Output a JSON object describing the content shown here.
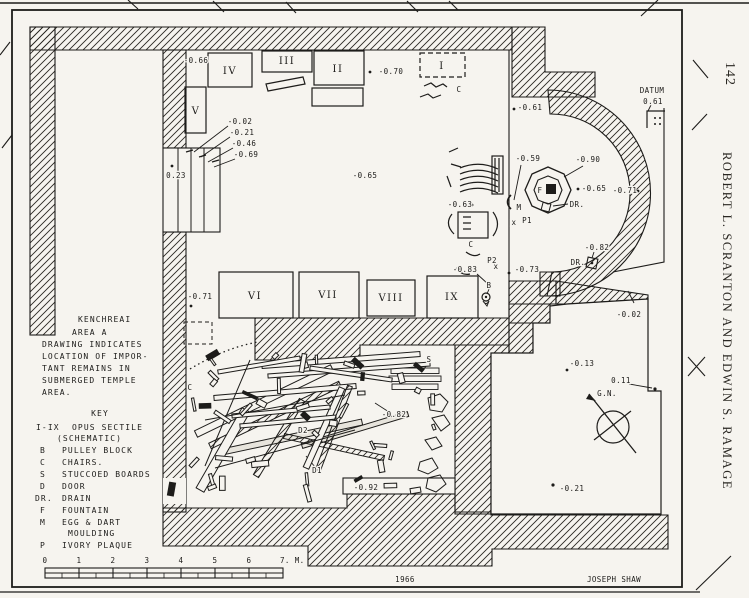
{
  "page": {
    "number": "142",
    "running_header": "ROBERT L. SCRANTON AND EDWIN S. RAMAGE"
  },
  "drawing": {
    "title_lines": [
      "KENCHREAI",
      "AREA A",
      "DRAWING INDICATES",
      "LOCATION OF IMPOR-",
      "TANT REMAINS IN",
      "SUBMERGED TEMPLE",
      "AREA."
    ],
    "key": {
      "heading": "KEY",
      "rows": [
        {
          "sym": "I-IX",
          "desc": "OPUS SECTILE"
        },
        {
          "sym": "",
          "desc": "(SCHEMATIC)"
        },
        {
          "sym": "B",
          "desc": "PULLEY BLOCK"
        },
        {
          "sym": "C",
          "desc": "CHAIRS."
        },
        {
          "sym": "S",
          "desc": "STUCCOED BOARDS"
        },
        {
          "sym": "D",
          "desc": "DOOR"
        },
        {
          "sym": "DR.",
          "desc": "DRAIN"
        },
        {
          "sym": "F",
          "desc": "FOUNTAIN"
        },
        {
          "sym": "M",
          "desc": "EGG & DART"
        },
        {
          "sym": "",
          "desc": "MOULDING"
        },
        {
          "sym": "P",
          "desc": "IVORY PLAQUE"
        }
      ]
    },
    "panel_labels": [
      {
        "t": "I",
        "x": 442,
        "y": 69
      },
      {
        "t": "II",
        "x": 338,
        "y": 72
      },
      {
        "t": "III",
        "x": 287,
        "y": 64
      },
      {
        "t": "IV",
        "x": 230,
        "y": 74
      },
      {
        "t": "V",
        "x": 196,
        "y": 114
      },
      {
        "t": "VI",
        "x": 255,
        "y": 299
      },
      {
        "t": "VII",
        "x": 328,
        "y": 298
      },
      {
        "t": "VIII",
        "x": 391,
        "y": 301
      },
      {
        "t": "IX",
        "x": 452,
        "y": 300
      }
    ],
    "annotations": [
      {
        "t": "-0.66",
        "x": 196,
        "y": 63
      },
      {
        "t": "-0.02",
        "x": 240,
        "y": 124
      },
      {
        "t": "-0.21",
        "x": 242,
        "y": 135
      },
      {
        "t": "-0.46",
        "x": 244,
        "y": 146
      },
      {
        "t": "-0.69",
        "x": 246,
        "y": 157
      },
      {
        "t": "0.23",
        "x": 176,
        "y": 178
      },
      {
        "t": "-0.70",
        "x": 391,
        "y": 74
      },
      {
        "t": "C",
        "x": 459,
        "y": 92
      },
      {
        "t": "-0.65",
        "x": 365,
        "y": 178
      },
      {
        "t": "-0.61",
        "x": 530,
        "y": 110
      },
      {
        "t": "-0.59",
        "x": 528,
        "y": 161
      },
      {
        "t": "-0.90",
        "x": 588,
        "y": 162
      },
      {
        "t": "F",
        "x": 540,
        "y": 193,
        "fs": 8
      },
      {
        "t": "DR.",
        "x": 577,
        "y": 207
      },
      {
        "t": "-0.65",
        "x": 594,
        "y": 191
      },
      {
        "t": "-0.71",
        "x": 625,
        "y": 193
      },
      {
        "t": "M",
        "x": 519,
        "y": 210
      },
      {
        "t": "x",
        "x": 514,
        "y": 225,
        "fs": 6
      },
      {
        "t": "P1",
        "x": 527,
        "y": 223
      },
      {
        "t": "-0.63",
        "x": 460,
        "y": 207
      },
      {
        "t": "C",
        "x": 471,
        "y": 247
      },
      {
        "t": "P2",
        "x": 492,
        "y": 263
      },
      {
        "t": "x",
        "x": 496,
        "y": 269,
        "fs": 6
      },
      {
        "t": "-0.83",
        "x": 465,
        "y": 272
      },
      {
        "t": "-0.73",
        "x": 527,
        "y": 272
      },
      {
        "t": "B",
        "x": 489,
        "y": 288
      },
      {
        "t": "-0.82",
        "x": 597,
        "y": 250
      },
      {
        "t": "DR.",
        "x": 578,
        "y": 265
      },
      {
        "t": "-0.71",
        "x": 200,
        "y": 299
      },
      {
        "t": "C",
        "x": 190,
        "y": 390
      },
      {
        "t": "S",
        "x": 429,
        "y": 362
      },
      {
        "t": "-0.82",
        "x": 394,
        "y": 417
      },
      {
        "t": "D2",
        "x": 303,
        "y": 433
      },
      {
        "t": "D1",
        "x": 317,
        "y": 473
      },
      {
        "t": "-0.92",
        "x": 366,
        "y": 490
      },
      {
        "t": "-0.02",
        "x": 629,
        "y": 317
      },
      {
        "t": "-0.13",
        "x": 582,
        "y": 366
      },
      {
        "t": "0.11",
        "x": 621,
        "y": 383
      },
      {
        "t": "G.N.",
        "x": 607,
        "y": 396,
        "fs": 7
      },
      {
        "t": "-0.21",
        "x": 572,
        "y": 491
      },
      {
        "t": "DATUM",
        "x": 652,
        "y": 93
      },
      {
        "t": "0.61",
        "x": 653,
        "y": 104
      },
      {
        "t": "1966",
        "x": 405,
        "y": 582
      },
      {
        "t": "JOSEPH SHAW",
        "x": 614,
        "y": 582
      }
    ],
    "scale_bar": {
      "labels": [
        "0",
        "1",
        "2",
        "3",
        "4",
        "5",
        "6"
      ],
      "end_label": "7. M."
    },
    "credits": {
      "year": "1966",
      "drafter": "JOSEPH SHAW"
    },
    "datum": {
      "label": "DATUM",
      "value": "0.61"
    },
    "north_label": "G.N."
  },
  "colors": {
    "ink": "#1d1c1a",
    "paper": "#f6f4ef"
  }
}
